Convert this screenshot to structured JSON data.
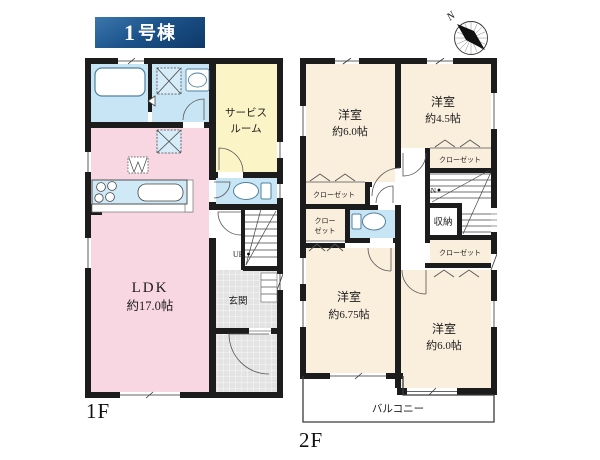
{
  "header": {
    "building_no": "1",
    "building_suffix": "号棟"
  },
  "compass": {
    "north_label": "N"
  },
  "floor1": {
    "floor_label": "1F",
    "ldk_name": "LDK",
    "ldk_size": "約17.0帖",
    "service_room_line1": "サービス",
    "service_room_line2": "ルーム",
    "entrance_label": "玄関",
    "stairs_up_label": "UP"
  },
  "floor2": {
    "floor_label": "2F",
    "bedroom_nw_name": "洋室",
    "bedroom_nw_size": "約6.0帖",
    "bedroom_ne_name": "洋室",
    "bedroom_ne_size": "約4.5帖",
    "bedroom_sw_name": "洋室",
    "bedroom_sw_size": "約6.75帖",
    "bedroom_se_name": "洋室",
    "bedroom_se_size": "約6.0帖",
    "closet_ne_label": "クローゼット",
    "closet_nw_label": "クローゼット",
    "closet_w_line1": "クロー",
    "closet_w_line2": "ゼット",
    "closet_e_label": "クローゼット",
    "storage_label": "収納",
    "stairs_down_label": "DN",
    "balcony_label": "バルコニー"
  },
  "colors": {
    "room_pink": "#f8d7e3",
    "room_blue": "#c7e5f4",
    "room_yellow": "#fbf4c6",
    "room_cream": "#faeedd",
    "wall": "#1c1c1c",
    "tile_gray": "#e3e3e3",
    "badge_blue_light": "#3b77ad",
    "badge_blue_dark": "#0e3868"
  }
}
